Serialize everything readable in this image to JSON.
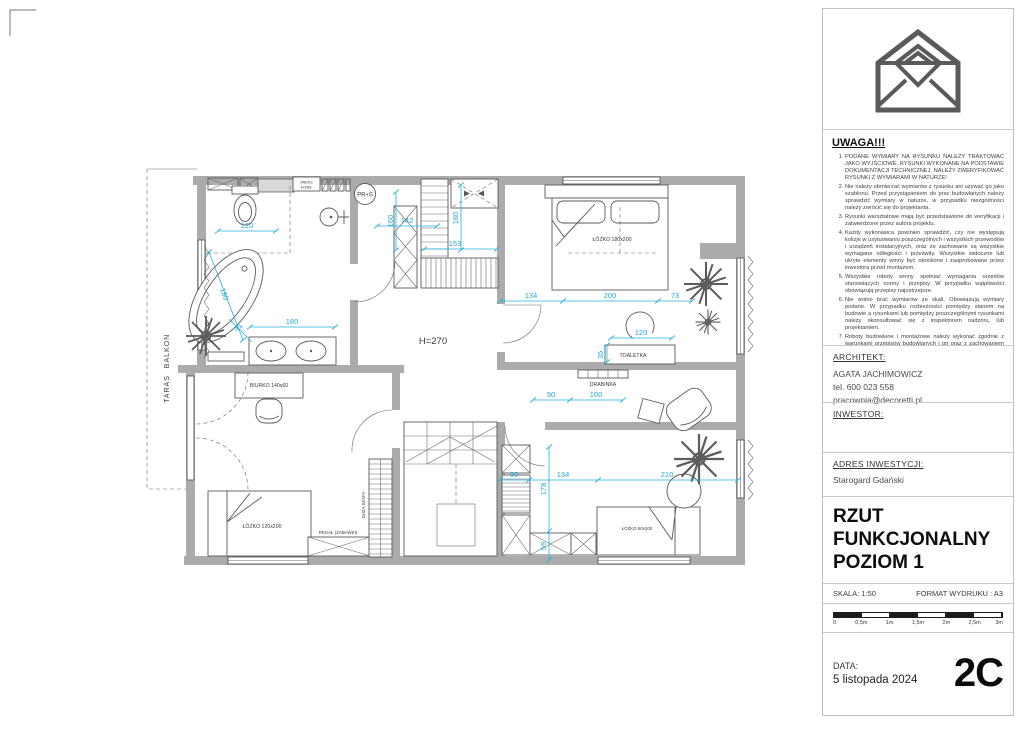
{
  "title_block": {
    "uwaga": {
      "heading": "UWAGA!!!",
      "items": [
        "PODANE WYMIARY NA RYSUNKU NALEŻY TRAKTOWAĆ JAKO WYJŚCIOWE. RYSUNKI WYKONANE NA PODSTAWIE DOKUMENTACJI TECHNICZNEJ. NALEŻY ZWERYFIKOWAĆ RYSUNKI Z WYMIARAMI W NATURZE!",
        "Nie należy obmierzać wymiarów z rysunku ani używać go jako szablonu. Przed przystąpieniem do prac budowlanych należy sprawdzić wymiary w naturze, w przypadku niezgodności należy zwrócić się do projektanta.",
        "Rysunki warsztatowe mają być przedstawione do weryfikacji i zatwierdzone przez autora projektu.",
        "Każdy wykonawca powinien sprawdzić, czy nie występują kolizje w usytuowaniu poszczególnych i wszystkich przewodów i urządzeń instalacyjnych, oraz że zachowane są wszystkie wymagane odległości i prześwity. Wszystkie widoczne lub ukryte elementy winny być określone i zaaprobowane przez inwestora przed montażem.",
        "Wszystkie roboty winny spełniać wymagania urzędów stanowiących normy i przepisy. W przypadku wątpliwości obowiązują przepisy najostrzejsze.",
        "Nie wolno brać wymiarów ze skali. Obowiązują wymiary podane. W przypadku rozbieżności pomiędzy stanem na budowie a rysunkami lub pomiędzy poszczególnymi rysunkami należy skonsultować się z inspektorem nadzoru, lub projektantem.",
        "Roboty budowlane i montażowe należy wykonać zgodnie z warunkami przepisów budowlanych i pn oraz z zachowaniem przepisów bhp.",
        "Wszystkie wymiary stolarki i ślusarki drzwiowej i okiennej, wewnętrznej i zewnętrznej należy sprawdzić w naturze przed realizacją."
      ]
    },
    "architekt": {
      "heading": "ARCHITEKT:",
      "name": "AGATA JACHIMOWICZ",
      "tel": "tel. 600 023 558",
      "email": "pracownia@decoretti.pl"
    },
    "inwestor": {
      "heading": "INWESTOR:"
    },
    "adres": {
      "heading": "ADRES INWESTYCJI:",
      "value": "Starogard Gdański"
    },
    "title": "RZUT FUNKCJONALNY POZIOM 1",
    "skala": "SKALA: 1:50",
    "format": "FORMAT WYDRUKU : A3",
    "scalebar": [
      "0",
      "0,5m",
      "1m",
      "1,5m",
      "2m",
      "2,5m",
      "3m"
    ],
    "data_label": "DATA:",
    "data_value": "5 listopada 2024",
    "revision": "2C"
  },
  "plan": {
    "labels": {
      "aneks1": "ANEKS",
      "aneks2": "KOSM.",
      "prs": "PR+S",
      "h270": "H=270",
      "toaletka": "TOALETKA",
      "drabinka": "DRABINKA",
      "biurko": "BIURKO 140x60",
      "lozko180": "ŁÓŻKO 180x200",
      "lozko120": "ŁÓŻKO 120x200",
      "lozko90": "ŁÓŻKO 90x200",
      "regal": "REGAŁ (ZABAWKI)",
      "szafa": "DUŻA SZAFA",
      "taras": "TARAS",
      "balkon": "BALKON"
    },
    "dims": {
      "d120wc": "120",
      "d142": "142",
      "d160a": "160",
      "d160b": "160",
      "d153": "153",
      "d134a": "134",
      "d200": "200",
      "d73": "73",
      "d180tub": "180",
      "d41": "41",
      "d180van": "180",
      "d35": "35",
      "d120toa": "120",
      "d50": "50",
      "d100": "100",
      "d90": "90",
      "d134b": "134",
      "d210": "210",
      "d178": "178",
      "d59": "59"
    }
  }
}
